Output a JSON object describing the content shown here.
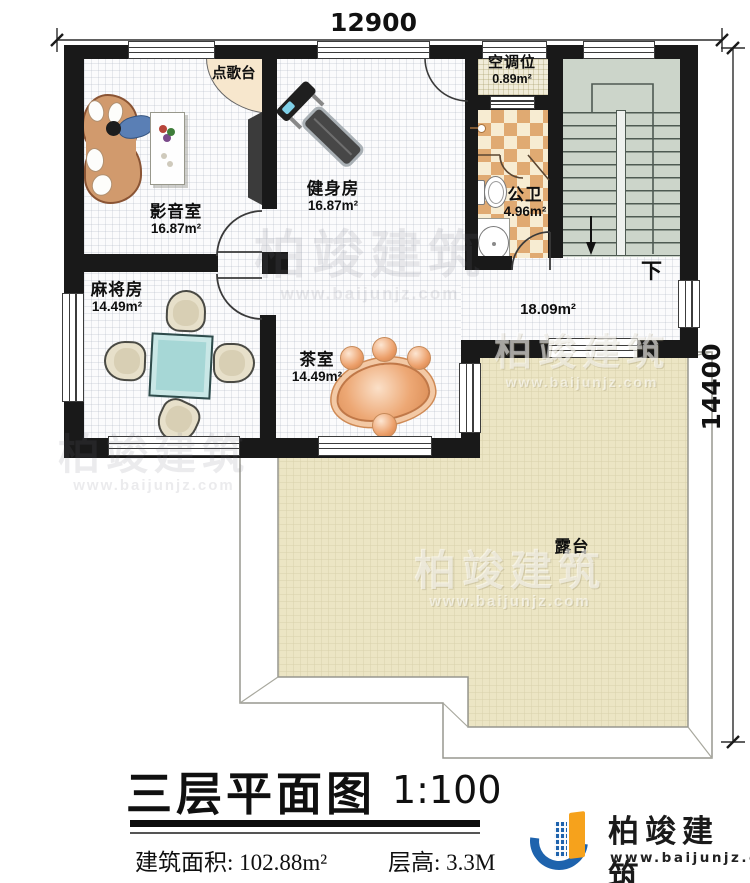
{
  "dimensions": {
    "top": "12900",
    "right": "14400"
  },
  "rooms": {
    "media": {
      "name": "影音室",
      "area": "16.87m²"
    },
    "gym": {
      "name": "健身房",
      "area": "16.87m²"
    },
    "mahjong": {
      "name": "麻将房",
      "area": "14.49m²"
    },
    "tea": {
      "name": "茶室",
      "area": "14.49m²"
    },
    "ac": {
      "name": "空调位",
      "area": "0.89m²"
    },
    "wc": {
      "name": "公卫",
      "area": "4.96m²"
    },
    "hall": {
      "area": "18.09m²"
    },
    "terrace": {
      "name": "露台"
    }
  },
  "annotations": {
    "karaoke": "点歌台",
    "stairs_down": "下"
  },
  "title_block": {
    "title": "三层平面图",
    "scale": "1:100",
    "build_area": "建筑面积: 102.88m²",
    "floor_height": "层高: 3.3M"
  },
  "brand": {
    "name": "柏竣建筑",
    "site": "www.baijunjz.com"
  },
  "watermark": {
    "name": "柏竣建筑",
    "site": "www.baijunjz.com"
  },
  "colors": {
    "wall": "#191919",
    "stair_fill": "#ccd5ca",
    "terrace_fill": "#ece5c4",
    "checker_dark": "#e0aa72",
    "checker_light": "#f7ecd2",
    "logo_blue": "#1e63ad",
    "logo_orange": "#f6a21c"
  }
}
